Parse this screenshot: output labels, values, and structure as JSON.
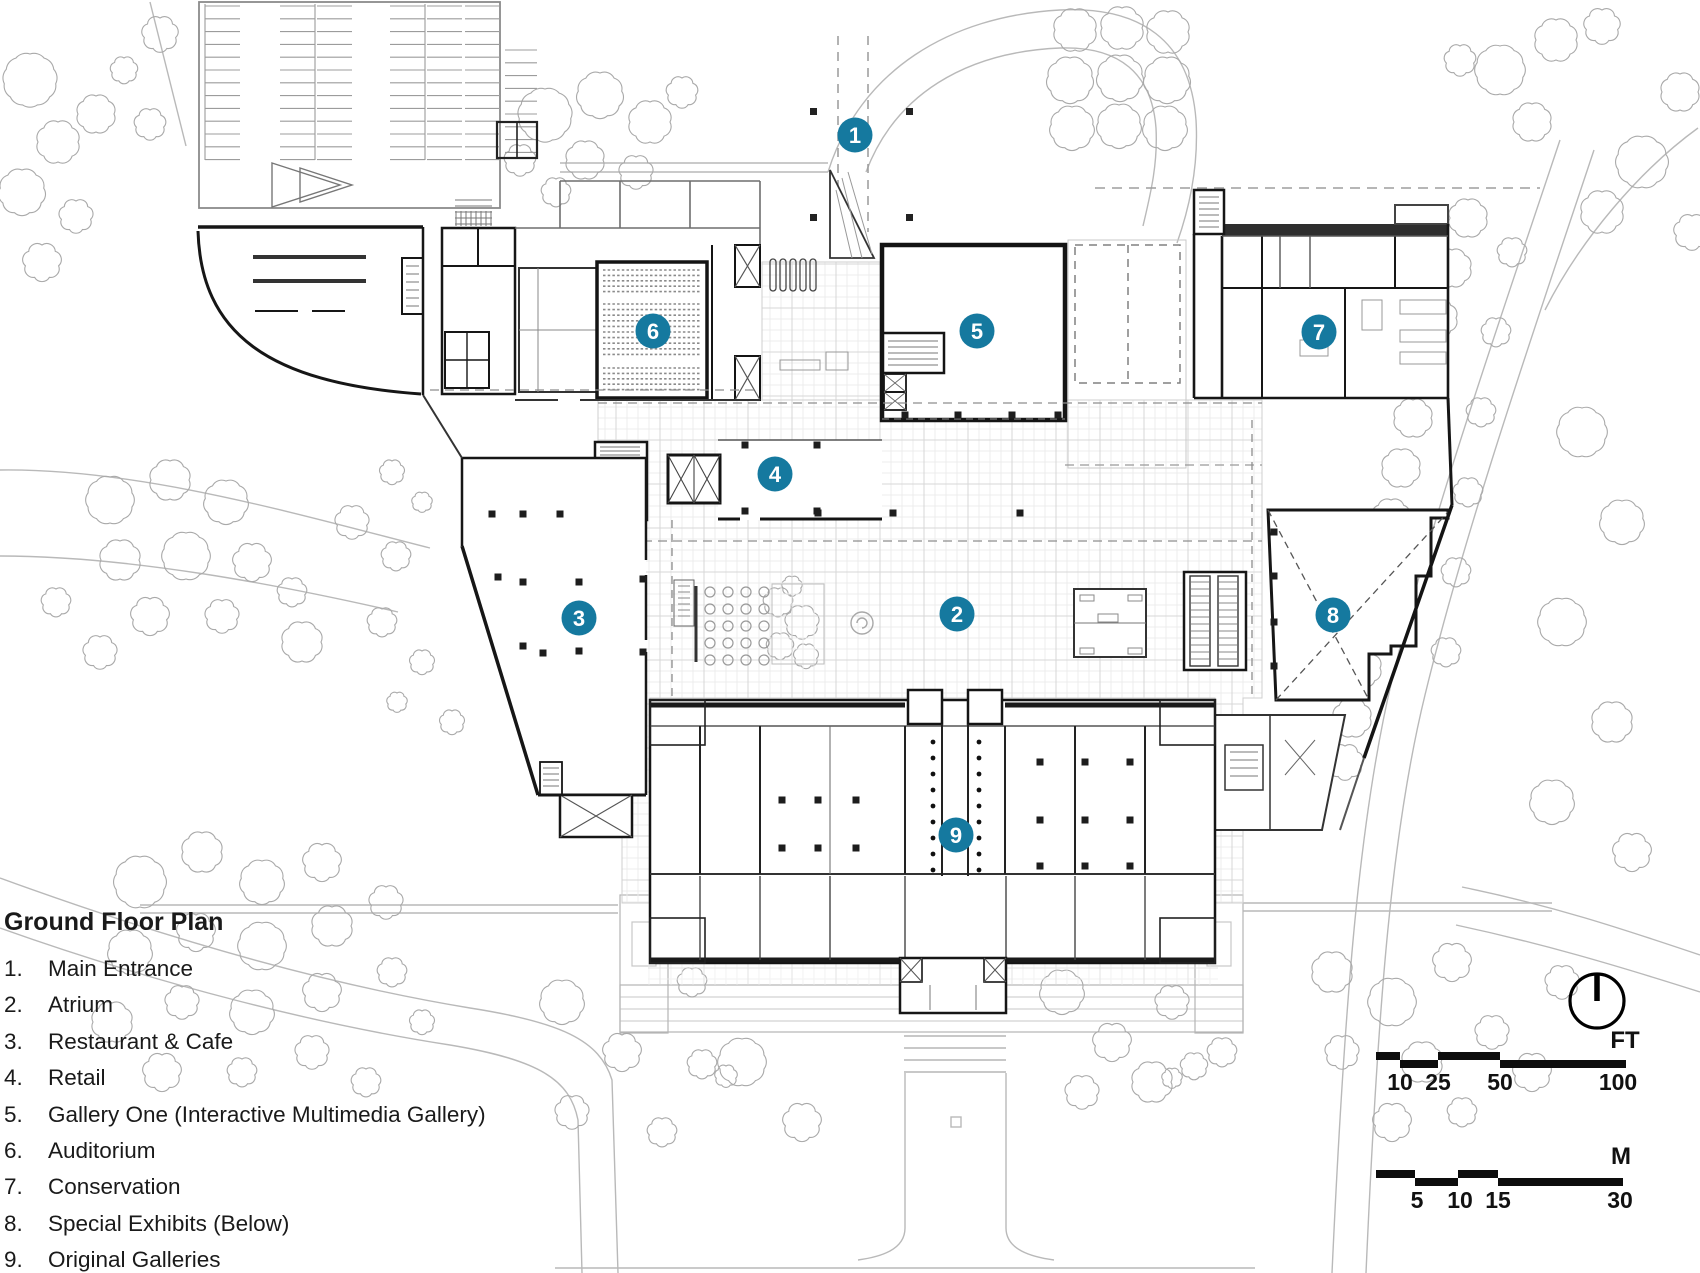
{
  "plan": {
    "title": "Ground Floor Plan",
    "legend": [
      {
        "num": "1.",
        "label": "Main Entrance"
      },
      {
        "num": "2.",
        "label": "Atrium"
      },
      {
        "num": "3.",
        "label": "Restaurant & Cafe"
      },
      {
        "num": "4.",
        "label": "Retail"
      },
      {
        "num": "5.",
        "label": "Gallery One (Interactive Multimedia Gallery)"
      },
      {
        "num": "6.",
        "label": "Auditorium"
      },
      {
        "num": "7.",
        "label": "Conservation"
      },
      {
        "num": "8.",
        "label": "Special Exhibits (Below)"
      },
      {
        "num": "9.",
        "label": "Original Galleries"
      }
    ],
    "markers": [
      {
        "n": "1",
        "x": 855,
        "y": 135
      },
      {
        "n": "2",
        "x": 957,
        "y": 614
      },
      {
        "n": "3",
        "x": 579,
        "y": 618
      },
      {
        "n": "4",
        "x": 775,
        "y": 474
      },
      {
        "n": "5",
        "x": 977,
        "y": 331
      },
      {
        "n": "6",
        "x": 653,
        "y": 331
      },
      {
        "n": "7",
        "x": 1319,
        "y": 332
      },
      {
        "n": "8",
        "x": 1333,
        "y": 615
      },
      {
        "n": "9",
        "x": 956,
        "y": 835
      }
    ],
    "marker_color": "#15799F",
    "scalebars": {
      "ft": {
        "unit": "FT",
        "labels": [
          {
            "t": "10",
            "x": 1400
          },
          {
            "t": "25",
            "x": 1438
          },
          {
            "t": "50",
            "x": 1500
          },
          {
            "t": "100",
            "x": 1618
          }
        ]
      },
      "m": {
        "unit": "M",
        "labels": [
          {
            "t": "5",
            "x": 1417
          },
          {
            "t": "10",
            "x": 1460
          },
          {
            "t": "15",
            "x": 1498
          },
          {
            "t": "30",
            "x": 1620
          }
        ]
      }
    }
  }
}
